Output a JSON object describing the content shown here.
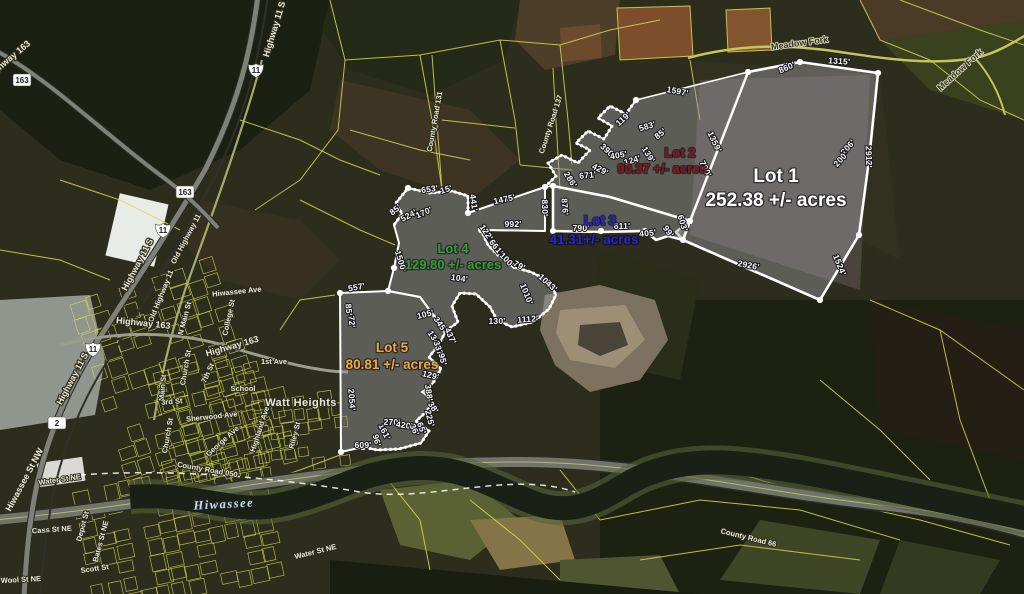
{
  "palette": {
    "boundary": "#ffffff",
    "parcel_line": "#d8da4e",
    "lot_fill": "#9a9aa0"
  },
  "map_labels": {
    "lots": [
      {
        "name": "Lot 1",
        "acres": "252.38 +/- acres",
        "color": "#ffffff",
        "size": 19,
        "name_pos": [
          776,
          182
        ],
        "acres_pos": [
          776,
          206
        ]
      },
      {
        "name": "Lot 2",
        "acres": "90.37 +/- acres",
        "color": "#8f1220",
        "size": 13,
        "name_pos": [
          680,
          157
        ],
        "acres_pos": [
          662,
          173
        ]
      },
      {
        "name": "Lot 3",
        "acres": "41.31+/- acres",
        "color": "#2b1fd8",
        "size": 13.5,
        "name_pos": [
          600,
          225
        ],
        "acres_pos": [
          594,
          244
        ]
      },
      {
        "name": "Lot 4",
        "acres": "129.80 +/- acres",
        "color": "#2fa12f",
        "size": 13,
        "name_pos": [
          453,
          253
        ],
        "acres_pos": [
          453,
          269
        ]
      },
      {
        "name": "Lot 5",
        "acres": "80.81 +/- acres",
        "color": "#f0a83a",
        "size": 13.5,
        "name_pos": [
          392,
          352
        ],
        "acres_pos": [
          392,
          369
        ]
      }
    ],
    "measurements": [
      [
        "860'",
        788,
        70,
        -24
      ],
      [
        "1315'",
        839,
        64,
        4
      ],
      [
        "1597'",
        677,
        94,
        11
      ],
      [
        "1359'",
        712,
        143,
        64
      ],
      [
        "790'",
        703,
        170,
        64
      ],
      [
        "2912'",
        866,
        157,
        88
      ],
      [
        "206'",
        850,
        149,
        -48
      ],
      [
        "200'",
        843,
        161,
        -48
      ],
      [
        "1524'",
        837,
        266,
        68
      ],
      [
        "2926'",
        748,
        268,
        11
      ],
      [
        "603'",
        680,
        224,
        72
      ],
      [
        "99'",
        666,
        233,
        55
      ],
      [
        "405'",
        648,
        236,
        -6
      ],
      [
        "611'",
        622,
        229,
        0
      ],
      [
        "790'",
        581,
        231,
        0
      ],
      [
        "119'",
        625,
        121,
        -42
      ],
      [
        "583'",
        648,
        129,
        -16
      ],
      [
        "85'",
        662,
        136,
        -38
      ],
      [
        "390'",
        606,
        153,
        42
      ],
      [
        "405'",
        619,
        158,
        -10
      ],
      [
        "124'",
        633,
        163,
        -16
      ],
      [
        "139'",
        646,
        156,
        58
      ],
      [
        "429'",
        599,
        172,
        26
      ],
      [
        "671'",
        588,
        178,
        -6
      ],
      [
        "286'",
        568,
        181,
        58
      ],
      [
        "876'",
        562,
        207,
        86
      ],
      [
        "830'",
        542,
        208,
        88
      ],
      [
        "1475'",
        505,
        202,
        -12
      ],
      [
        "992'",
        513,
        227,
        0
      ],
      [
        "653'",
        430,
        192,
        -8
      ],
      [
        "15'",
        447,
        192,
        -18
      ],
      [
        "441'",
        471,
        203,
        82
      ],
      [
        "85'",
        397,
        212,
        -38
      ],
      [
        "524'",
        410,
        218,
        -28
      ],
      [
        "170'",
        425,
        215,
        -24
      ],
      [
        "1500'",
        398,
        262,
        73
      ],
      [
        "557'",
        357,
        290,
        -10
      ],
      [
        "85'",
        346,
        310,
        84
      ],
      [
        "72'",
        349,
        322,
        84
      ],
      [
        "122'",
        484,
        234,
        56
      ],
      [
        "661'",
        494,
        249,
        52
      ],
      [
        "100'",
        505,
        262,
        46
      ],
      [
        "79'",
        518,
        268,
        28
      ],
      [
        "104'",
        459,
        281,
        8
      ],
      [
        "1043'",
        546,
        285,
        42
      ],
      [
        "1010'",
        524,
        295,
        68
      ],
      [
        "1112'",
        528,
        322,
        -4
      ],
      [
        "130'",
        497,
        324,
        0
      ],
      [
        "105'",
        426,
        317,
        -14
      ],
      [
        "345'",
        438,
        326,
        56
      ],
      [
        "437'",
        448,
        337,
        66
      ],
      [
        "134'",
        432,
        340,
        56
      ],
      [
        "337'",
        436,
        350,
        72
      ],
      [
        "95'",
        440,
        360,
        76
      ],
      [
        "129'",
        430,
        378,
        14
      ],
      [
        "388'",
        426,
        393,
        82
      ],
      [
        "2054'",
        349,
        400,
        86
      ],
      [
        "609'",
        363,
        448,
        0
      ],
      [
        "96'",
        374,
        441,
        76
      ],
      [
        "161'",
        382,
        433,
        64
      ],
      [
        "270'",
        392,
        425,
        2
      ],
      [
        "420'",
        404,
        428,
        8
      ],
      [
        "36'",
        412,
        431,
        64
      ],
      [
        "65'",
        419,
        429,
        70
      ],
      [
        "225'",
        427,
        419,
        76
      ],
      [
        "38'",
        431,
        409,
        56
      ]
    ],
    "roads": [
      {
        "t": "Highway 11 S",
        "x": 277,
        "y": 30,
        "r": -73
      },
      {
        "t": "Highway 163",
        "x": 10,
        "y": 62,
        "r": -40
      },
      {
        "t": "Meadow Fork",
        "x": 800,
        "y": 46,
        "r": -8,
        "style": "dark"
      },
      {
        "t": "Meadow Fork",
        "x": 962,
        "y": 72,
        "r": -42,
        "style": "dark"
      },
      {
        "t": "County Road 131",
        "x": 437,
        "y": 122,
        "r": -80,
        "style": "small"
      },
      {
        "t": "County Road 137",
        "x": 553,
        "y": 125,
        "r": -72,
        "style": "small"
      },
      {
        "t": "Highway 11 S",
        "x": 140,
        "y": 266,
        "r": -62
      },
      {
        "t": "Old Highway 11",
        "x": 188,
        "y": 240,
        "r": -62,
        "style": "small"
      },
      {
        "t": "Old Highway 11",
        "x": 163,
        "y": 297,
        "r": -68,
        "style": "small"
      },
      {
        "t": "Highway 163",
        "x": 143,
        "y": 326,
        "r": 6
      },
      {
        "t": "Hiwassee Ave",
        "x": 237,
        "y": 294,
        "r": -6,
        "style": "small"
      },
      {
        "t": "N Main St",
        "x": 187,
        "y": 319,
        "r": -75,
        "style": "small"
      },
      {
        "t": "College St",
        "x": 231,
        "y": 318,
        "r": -78,
        "style": "small"
      },
      {
        "t": "Highway 163",
        "x": 233,
        "y": 349,
        "r": -16
      },
      {
        "t": "1st Ave",
        "x": 274,
        "y": 364,
        "r": 0,
        "style": "small"
      },
      {
        "t": "Church St",
        "x": 188,
        "y": 368,
        "r": -80,
        "style": "small"
      },
      {
        "t": "7th St",
        "x": 210,
        "y": 374,
        "r": -65,
        "style": "small"
      },
      {
        "t": "Main St",
        "x": 165,
        "y": 388,
        "r": -85,
        "style": "small"
      },
      {
        "t": "School",
        "x": 243,
        "y": 391,
        "r": 0,
        "style": "small"
      },
      {
        "t": "Highway 11 S",
        "x": 75,
        "y": 380,
        "r": -62
      },
      {
        "t": "Watt Heights",
        "x": 301,
        "y": 406,
        "r": 0,
        "style": "big"
      },
      {
        "t": "3rd St",
        "x": 172,
        "y": 404,
        "r": -4,
        "style": "small"
      },
      {
        "t": "Sherwood Ave",
        "x": 212,
        "y": 419,
        "r": -6,
        "style": "small"
      },
      {
        "t": "Highland Ave",
        "x": 262,
        "y": 430,
        "r": -72,
        "style": "small"
      },
      {
        "t": "Riley St",
        "x": 297,
        "y": 436,
        "r": -75,
        "style": "small"
      },
      {
        "t": "Church St",
        "x": 170,
        "y": 436,
        "r": -80,
        "style": "small"
      },
      {
        "t": "George Ave",
        "x": 224,
        "y": 443,
        "r": -42,
        "style": "small"
      },
      {
        "t": "County Road 050",
        "x": 207,
        "y": 472,
        "r": 10,
        "style": "small"
      },
      {
        "t": "Water St NE",
        "x": 60,
        "y": 482,
        "r": -8,
        "style": "small"
      },
      {
        "t": "Hiwassee St NW",
        "x": 27,
        "y": 481,
        "r": -62
      },
      {
        "t": "Hiwassee",
        "x": 224,
        "y": 508,
        "r": -3,
        "style": "water"
      },
      {
        "t": "Cass St NE",
        "x": 52,
        "y": 532,
        "r": -4,
        "style": "small"
      },
      {
        "t": "Depot St",
        "x": 85,
        "y": 527,
        "r": -75,
        "style": "small"
      },
      {
        "t": "Bates St NE",
        "x": 103,
        "y": 542,
        "r": -75,
        "style": "small"
      },
      {
        "t": "Scott St",
        "x": 95,
        "y": 571,
        "r": -8,
        "style": "small"
      },
      {
        "t": "Wool St NE",
        "x": 21,
        "y": 582,
        "r": -3,
        "style": "small"
      },
      {
        "t": "Water St NE",
        "x": 316,
        "y": 554,
        "r": -14,
        "style": "small"
      },
      {
        "t": "County Road 66",
        "x": 748,
        "y": 540,
        "r": 14,
        "style": "small"
      }
    ],
    "shields": [
      {
        "n": "163",
        "x": 22,
        "y": 80,
        "kind": "box"
      },
      {
        "n": "11",
        "x": 256,
        "y": 70,
        "kind": "us"
      },
      {
        "n": "163",
        "x": 185,
        "y": 192,
        "kind": "box"
      },
      {
        "n": "11",
        "x": 163,
        "y": 230,
        "kind": "us"
      },
      {
        "n": "11",
        "x": 93,
        "y": 349,
        "kind": "us"
      },
      {
        "n": "2",
        "x": 57,
        "y": 423,
        "kind": "box"
      }
    ]
  }
}
